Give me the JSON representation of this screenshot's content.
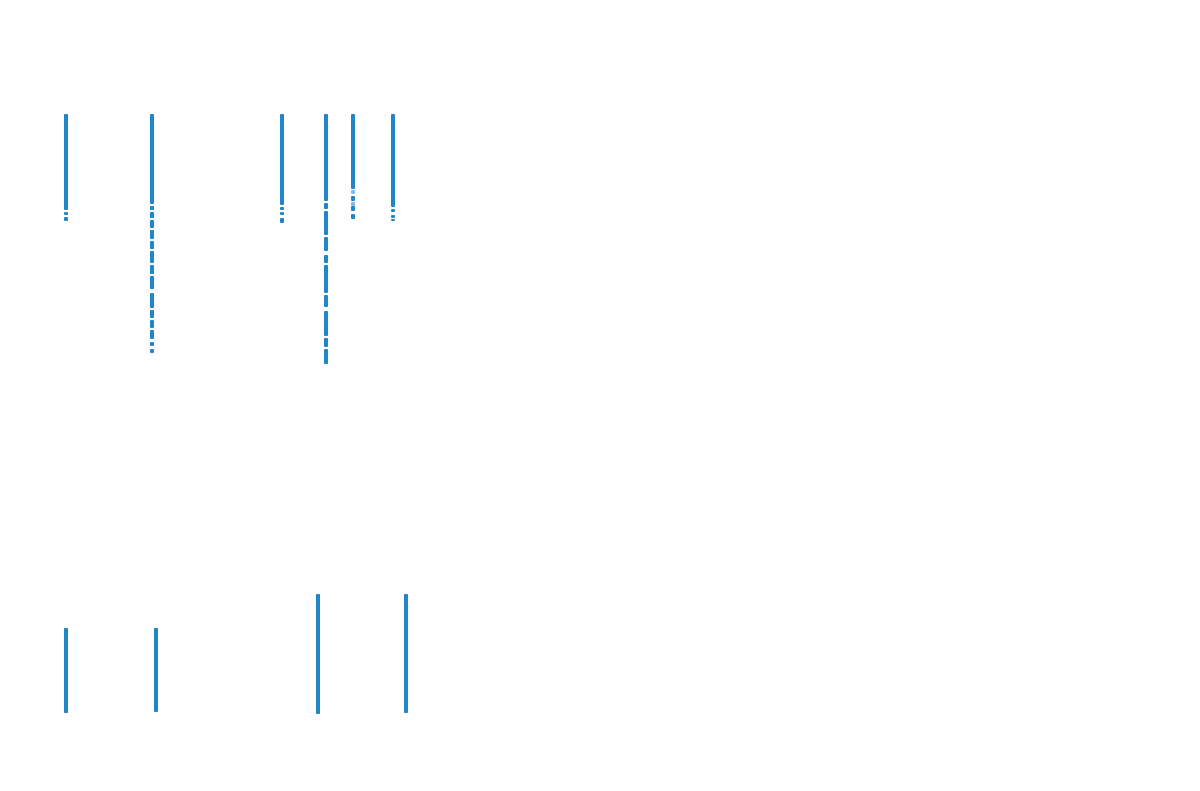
{
  "canvas": {
    "width_px": 1200,
    "height_px": 791,
    "background_color": "#ffffff"
  },
  "chart_data": {
    "type": "scatter",
    "title": "",
    "xlabel": "",
    "ylabel": "",
    "axes_visible": false,
    "grid": false,
    "legend": false,
    "marker_color": "#1f87c8",
    "marker_shape": "square",
    "strip_width_px": 4,
    "panels": [
      {
        "name": "top-event-group",
        "columns": [
          {
            "x": 66,
            "segments": [
              [
                114,
                210
              ],
              [
                212,
                215
              ],
              [
                217,
                221
              ]
            ]
          },
          {
            "x": 152,
            "segments": [
              [
                114,
                204
              ],
              [
                206,
                210
              ],
              [
                212,
                218
              ],
              [
                220,
                228
              ],
              [
                230,
                239
              ],
              [
                241,
                249
              ],
              [
                251,
                263
              ],
              [
                265,
                274
              ],
              [
                276,
                289
              ],
              [
                293,
                308
              ],
              [
                310,
                318
              ],
              [
                320,
                328
              ],
              [
                330,
                339
              ],
              [
                342,
                346
              ],
              [
                349,
                353
              ]
            ]
          },
          {
            "x": 282,
            "segments": [
              [
                114,
                205
              ],
              [
                207,
                210
              ],
              [
                212,
                215
              ],
              [
                218,
                223
              ]
            ]
          },
          {
            "x": 326,
            "segments": [
              [
                114,
                201
              ],
              [
                203,
                209
              ],
              [
                211,
                235
              ],
              [
                237,
                251
              ],
              [
                255,
                263
              ],
              [
                265,
                293
              ],
              [
                295,
                307
              ],
              [
                311,
                336
              ],
              [
                338,
                347
              ],
              [
                349,
                364
              ]
            ]
          },
          {
            "x": 353,
            "segments": [
              [
                114,
                189
              ],
              [
                190,
                194,
                0.55
              ],
              [
                196,
                201
              ],
              [
                202,
                206,
                0.55
              ],
              [
                206,
                211
              ],
              [
                214,
                219
              ]
            ]
          },
          {
            "x": 393,
            "segments": [
              [
                114,
                207
              ],
              [
                209,
                212
              ],
              [
                215,
                218
              ],
              [
                219,
                221
              ]
            ]
          }
        ]
      },
      {
        "name": "bottom-event-group",
        "columns": [
          {
            "x": 66,
            "segments": [
              [
                628,
                713
              ]
            ]
          },
          {
            "x": 156,
            "segments": [
              [
                628,
                712
              ]
            ]
          },
          {
            "x": 318,
            "segments": [
              [
                594,
                714
              ]
            ]
          },
          {
            "x": 406,
            "segments": [
              [
                594,
                713
              ]
            ]
          }
        ]
      }
    ]
  }
}
